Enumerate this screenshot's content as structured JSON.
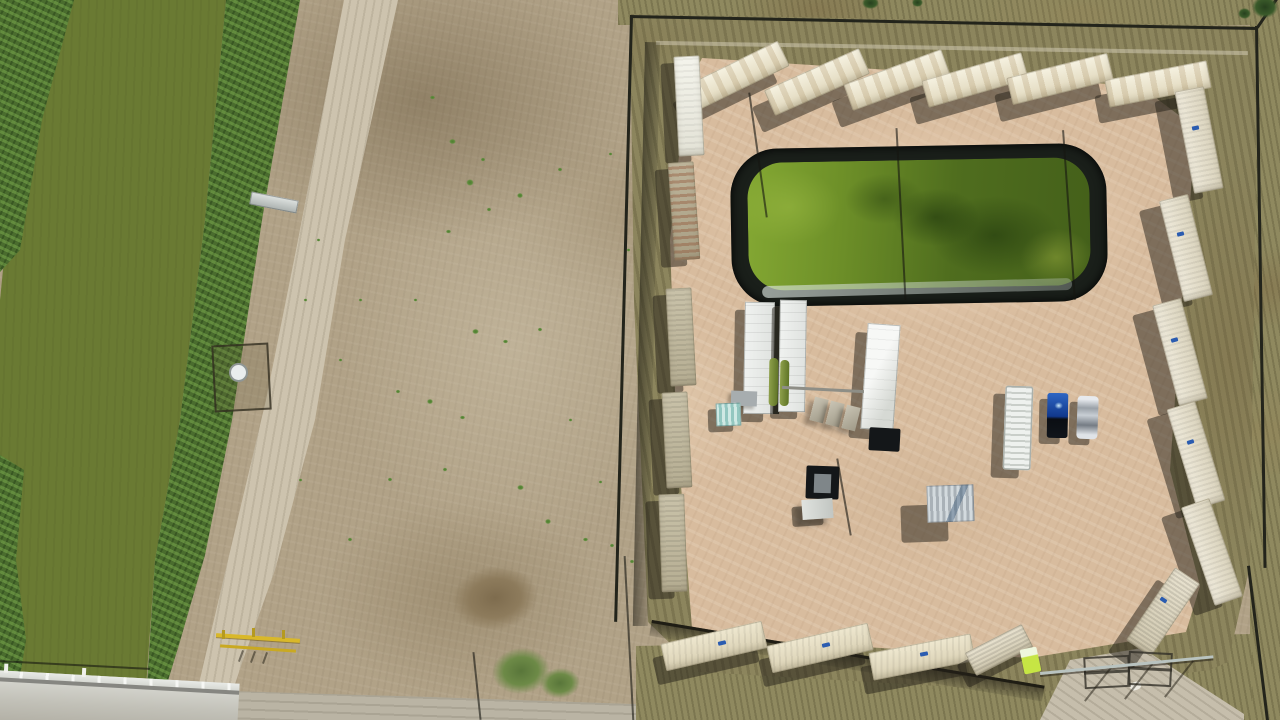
{
  "meta": {
    "scene_type": "aerial-drone-photo",
    "alt_text": "Top-down aerial view of a fenced well-pad compound ringed by shipping containers, with a black-lined green retention pond, white equipment trailers, two parked vehicles, a dirt road, and an irrigation canal with green water crossed by a concrete bridge"
  },
  "palette": {
    "field_tan": "#b1a287",
    "pad_pink": "#d8bc9e",
    "scrub_olive": "#8f895f",
    "canal_water_green": "#6a7a33",
    "vegetation_green": "#4a6c2e",
    "pond_water_green": "#5f7f24",
    "pond_liner_black": "#1a1f1a",
    "container_cream": "#e9e2ca",
    "road_tan": "#cdc3ae",
    "bridge_concrete": "#c6c5bc",
    "truck_blue": "#11388c",
    "gate_yellow": "#d9b829",
    "shadow": "rgba(36,31,24,0.5)"
  },
  "scene": {
    "objects": [
      {
        "n": "container-top-1",
        "cls": "cont top",
        "x": 685,
        "y": 62,
        "w": 104,
        "h": 28,
        "r": -26,
        "sx": -12,
        "sy": 17
      },
      {
        "n": "container-top-2",
        "cls": "cont top",
        "x": 765,
        "y": 68,
        "w": 104,
        "h": 28,
        "r": -24,
        "sx": -12,
        "sy": 17
      },
      {
        "n": "container-top-3",
        "cls": "cont top",
        "x": 845,
        "y": 66,
        "w": 104,
        "h": 28,
        "r": -20,
        "sx": -12,
        "sy": 17
      },
      {
        "n": "container-top-4",
        "cls": "cont top",
        "x": 923,
        "y": 66,
        "w": 104,
        "h": 28,
        "r": -16,
        "sx": -12,
        "sy": 17
      },
      {
        "n": "container-top-5",
        "cls": "cont top",
        "x": 1008,
        "y": 65,
        "w": 104,
        "h": 28,
        "r": -14,
        "sx": -12,
        "sy": 17
      },
      {
        "n": "container-top-6",
        "cls": "cont top",
        "x": 1106,
        "y": 70,
        "w": 104,
        "h": 28,
        "r": -11,
        "sx": -10,
        "sy": 16
      },
      {
        "n": "container-right-1",
        "cls": "cont side",
        "x": 1184,
        "y": 88,
        "w": 30,
        "h": 104,
        "r": -11,
        "sx": -20,
        "sy": 10
      },
      {
        "n": "container-right-2",
        "cls": "cont side",
        "x": 1171,
        "y": 196,
        "w": 30,
        "h": 104,
        "r": -14,
        "sx": -20,
        "sy": 10
      },
      {
        "n": "container-right-3",
        "cls": "cont side",
        "x": 1165,
        "y": 300,
        "w": 30,
        "h": 104,
        "r": -15,
        "sx": -20,
        "sy": 10
      },
      {
        "n": "container-right-4",
        "cls": "cont side",
        "x": 1181,
        "y": 403,
        "w": 30,
        "h": 104,
        "r": -17,
        "sx": -20,
        "sy": 10
      },
      {
        "n": "container-right-5",
        "cls": "cont side",
        "x": 1197,
        "y": 500,
        "w": 30,
        "h": 104,
        "r": -19,
        "sx": -20,
        "sy": 10
      },
      {
        "n": "container-corner",
        "cls": "cont corner",
        "x": 1148,
        "y": 568,
        "w": 30,
        "h": 88,
        "r": 34,
        "sx": -18,
        "sy": 12
      },
      {
        "n": "container-left-1",
        "cls": "cont white",
        "x": 676,
        "y": 56,
        "w": 26,
        "h": 100,
        "r": -3,
        "sx": -13,
        "sy": 7
      },
      {
        "n": "container-left-2",
        "cls": "cont rusty",
        "x": 671,
        "y": 162,
        "w": 26,
        "h": 98,
        "r": -4,
        "sx": -13,
        "sy": 7
      },
      {
        "n": "container-left-3",
        "cls": "cont leftc",
        "x": 668,
        "y": 288,
        "w": 26,
        "h": 98,
        "r": -3,
        "sx": -13,
        "sy": 7
      },
      {
        "n": "container-left-4",
        "cls": "cont leftc",
        "x": 664,
        "y": 392,
        "w": 26,
        "h": 96,
        "r": -3,
        "sx": -13,
        "sy": 7
      },
      {
        "n": "container-left-5",
        "cls": "cont leftc",
        "x": 660,
        "y": 494,
        "w": 26,
        "h": 98,
        "r": -2,
        "sx": -13,
        "sy": 7
      },
      {
        "n": "container-bottom-1",
        "cls": "cont bot",
        "x": 662,
        "y": 632,
        "w": 104,
        "h": 28,
        "r": -13,
        "sx": -8,
        "sy": 14
      },
      {
        "n": "container-bottom-2",
        "cls": "cont bot",
        "x": 768,
        "y": 634,
        "w": 104,
        "h": 28,
        "r": -13,
        "sx": -8,
        "sy": 14
      },
      {
        "n": "container-bottom-3",
        "cls": "cont bot",
        "x": 870,
        "y": 643,
        "w": 104,
        "h": 28,
        "r": -11,
        "sx": -8,
        "sy": 14
      },
      {
        "n": "container-bottom-4",
        "cls": "cont corner",
        "x": 967,
        "y": 637,
        "w": 64,
        "h": 26,
        "r": -27,
        "sx": -8,
        "sy": 12
      },
      {
        "n": "container-label",
        "cls": "chip",
        "x": 1192,
        "y": 126,
        "w": 7,
        "h": 4,
        "r": -11
      },
      {
        "n": "container-label",
        "cls": "chip",
        "x": 1177,
        "y": 232,
        "w": 7,
        "h": 4,
        "r": -14
      },
      {
        "n": "container-label",
        "cls": "chip",
        "x": 1171,
        "y": 338,
        "w": 7,
        "h": 4,
        "r": -15
      },
      {
        "n": "container-label",
        "cls": "chip",
        "x": 1187,
        "y": 440,
        "w": 7,
        "h": 4,
        "r": -17
      },
      {
        "n": "container-label",
        "cls": "chip",
        "x": 1160,
        "y": 598,
        "w": 7,
        "h": 4,
        "r": 34
      },
      {
        "n": "container-label",
        "cls": "chip",
        "x": 718,
        "y": 641,
        "w": 8,
        "h": 4,
        "r": -13
      },
      {
        "n": "container-label",
        "cls": "chip",
        "x": 822,
        "y": 643,
        "w": 8,
        "h": 4,
        "r": -13
      },
      {
        "n": "container-label",
        "cls": "chip",
        "x": 920,
        "y": 652,
        "w": 8,
        "h": 4,
        "r": -11
      },
      {
        "n": "equipment-gap",
        "cls": "gapd",
        "x": 771,
        "y": 306,
        "w": 9,
        "h": 108,
        "r": 1
      },
      {
        "n": "frac-tank-trailer-a",
        "cls": "trailer",
        "x": 744,
        "y": 302,
        "w": 30,
        "h": 112,
        "r": 1,
        "sx": -10,
        "sy": 8
      },
      {
        "n": "frac-tank-trailer-b",
        "cls": "trailer",
        "x": 779,
        "y": 300,
        "w": 27,
        "h": 112,
        "r": 1,
        "sx": -8,
        "sy": 7
      },
      {
        "n": "green-tank-1",
        "cls": "gtank",
        "x": 769,
        "y": 358,
        "w": 9,
        "h": 48,
        "r": 1
      },
      {
        "n": "green-tank-2",
        "cls": "gtank",
        "x": 780,
        "y": 360,
        "w": 9,
        "h": 46,
        "r": 1
      },
      {
        "n": "equipment-trailer-c",
        "cls": "trailer bright",
        "x": 864,
        "y": 324,
        "w": 33,
        "h": 106,
        "r": 4,
        "sx": -12,
        "sy": 9
      },
      {
        "n": "black-platform",
        "cls": "cellar",
        "x": 869,
        "y": 428,
        "w": 31,
        "h": 23,
        "r": 3
      },
      {
        "n": "pipe-run",
        "cls": "pipe",
        "x": 782,
        "y": 388,
        "w": 82,
        "h": 3,
        "r": 3
      },
      {
        "n": "skid-pad-1",
        "cls": "pad3",
        "x": 812,
        "y": 398,
        "w": 14,
        "h": 24,
        "r": 14
      },
      {
        "n": "skid-pad-2",
        "cls": "pad3",
        "x": 828,
        "y": 402,
        "w": 14,
        "h": 24,
        "r": 14
      },
      {
        "n": "skid-pad-3",
        "cls": "pad3",
        "x": 844,
        "y": 406,
        "w": 14,
        "h": 24,
        "r": 14
      },
      {
        "n": "gray-utility-box",
        "cls": "unit",
        "x": 731,
        "y": 391,
        "w": 26,
        "h": 15,
        "r": 2
      },
      {
        "n": "wellhead-cellar",
        "cls": "cellar",
        "x": 806,
        "y": 466,
        "w": 33,
        "h": 33,
        "r": 2
      },
      {
        "n": "wellhead",
        "cls": "cellinner",
        "x": 814,
        "y": 474,
        "w": 17,
        "h": 19,
        "r": 2
      },
      {
        "n": "white-service-unit",
        "cls": "unit2",
        "x": 802,
        "y": 499,
        "w": 31,
        "h": 20,
        "r": -4,
        "sx": -10,
        "sy": 7
      },
      {
        "n": "corrugated-shed",
        "cls": "shed",
        "x": 927,
        "y": 485,
        "w": 47,
        "h": 37,
        "r": -2,
        "sx": -26,
        "sy": 20
      },
      {
        "n": "teal-shed",
        "cls": "teal",
        "x": 716,
        "y": 403,
        "w": 25,
        "h": 23,
        "r": -2,
        "sx": -8,
        "sy": 6
      },
      {
        "n": "ribbed-tank-trailer",
        "cls": "ribbed",
        "x": 1004,
        "y": 386,
        "w": 28,
        "h": 84,
        "r": 2,
        "sx": -12,
        "sy": 8
      },
      {
        "n": "blue-pickup-truck",
        "cls": "truck",
        "x": 1047,
        "y": 393,
        "w": 21,
        "h": 45,
        "r": 1,
        "sx": -8,
        "sy": 6
      },
      {
        "n": "silver-car",
        "cls": "car",
        "x": 1077,
        "y": 396,
        "w": 21,
        "h": 43,
        "r": 2,
        "sx": -8,
        "sy": 6
      },
      {
        "n": "portable-toilet",
        "cls": "toilet",
        "x": 1022,
        "y": 648,
        "w": 17,
        "h": 25,
        "r": -12
      },
      {
        "n": "canal-walkway",
        "cls": "walk",
        "x": 250,
        "y": 196,
        "w": 48,
        "h": 13,
        "r": 11
      },
      {
        "n": "pump-enclosure",
        "cls": "enc",
        "x": 213,
        "y": 344,
        "w": 53,
        "h": 63,
        "r": -3
      },
      {
        "n": "round-tank",
        "cls": "circ",
        "x": 229,
        "y": 363,
        "w": 15,
        "h": 15,
        "r": 0
      },
      {
        "n": "yellow-gate-bar",
        "cls": "ybar",
        "x": 216,
        "y": 636,
        "w": 84,
        "h": 4,
        "r": 4
      },
      {
        "n": "yellow-gate-bar-2",
        "cls": "ybar2",
        "x": 220,
        "y": 647,
        "w": 76,
        "h": 3,
        "r": 4
      },
      {
        "n": "yellow-gate-post",
        "cls": "ypost",
        "x": 222,
        "y": 630,
        "w": 3,
        "h": 9,
        "r": 0
      },
      {
        "n": "yellow-gate-post",
        "cls": "ypost",
        "x": 252,
        "y": 628,
        "w": 3,
        "h": 9,
        "r": 0
      },
      {
        "n": "yellow-gate-post",
        "cls": "ypost",
        "x": 282,
        "y": 630,
        "w": 3,
        "h": 9,
        "r": 0
      },
      {
        "n": "gate-post-shadow",
        "cls": "gsh",
        "x": 240,
        "y": 650,
        "w": 2,
        "h": 12,
        "r": 20
      },
      {
        "n": "gate-post-shadow",
        "cls": "gsh",
        "x": 252,
        "y": 651,
        "w": 2,
        "h": 12,
        "r": 20
      },
      {
        "n": "gate-post-shadow",
        "cls": "gsh",
        "x": 264,
        "y": 652,
        "w": 2,
        "h": 12,
        "r": 20
      },
      {
        "n": "white-debris",
        "cls": "wdot",
        "x": 1130,
        "y": 682,
        "w": 11,
        "h": 8,
        "r": -18
      },
      {
        "n": "entry-gate-frame-1",
        "cls": "frame",
        "x": 1084,
        "y": 656,
        "w": 42,
        "h": 28,
        "r": -3
      },
      {
        "n": "entry-gate-frame-2",
        "cls": "frame",
        "x": 1128,
        "y": 652,
        "w": 40,
        "h": 30,
        "r": 3
      },
      {
        "n": "gate-post-shadow",
        "cls": "gsh",
        "x": 1098,
        "y": 660,
        "w": 2,
        "h": 46,
        "r": 38
      },
      {
        "n": "gate-post-shadow",
        "cls": "gsh",
        "x": 1138,
        "y": 658,
        "w": 2,
        "h": 46,
        "r": 38
      },
      {
        "n": "gate-post-shadow",
        "cls": "gsh",
        "x": 1178,
        "y": 656,
        "w": 2,
        "h": 46,
        "r": 38
      },
      {
        "n": "guy-wire",
        "cls": "cable",
        "x": 900,
        "y": 128,
        "w": 2,
        "h": 172,
        "r": -3
      },
      {
        "n": "guy-wire",
        "cls": "cable",
        "x": 1068,
        "y": 130,
        "w": 2,
        "h": 170,
        "r": -4
      },
      {
        "n": "pole-shadow",
        "cls": "cable",
        "x": 757,
        "y": 92,
        "w": 2,
        "h": 126,
        "r": -8
      },
      {
        "n": "boom-shadow",
        "cls": "cable",
        "x": 843,
        "y": 458,
        "w": 2,
        "h": 78,
        "r": -10
      },
      {
        "n": "fence-wire",
        "cls": "cable",
        "x": 476,
        "y": 652,
        "w": 2,
        "h": 68,
        "r": -6
      },
      {
        "n": "fence-wire",
        "cls": "cable",
        "x": 628,
        "y": 556,
        "w": 2,
        "h": 166,
        "r": -3
      },
      {
        "n": "power-line",
        "cls": "cable",
        "x": 0,
        "y": 664,
        "w": 150,
        "h": 2,
        "r": 3
      },
      {
        "n": "rubble-patch",
        "cls": "rubble",
        "x": 452,
        "y": 566,
        "w": 86,
        "h": 64,
        "r": -8
      },
      {
        "n": "grass-patch",
        "cls": "gpatch",
        "x": 492,
        "y": 648,
        "w": 58,
        "h": 46,
        "r": -6
      },
      {
        "n": "grass-patch",
        "cls": "gpatch",
        "x": 540,
        "y": 668,
        "w": 40,
        "h": 30,
        "r": -4
      },
      {
        "n": "tree-canopy",
        "cls": "tree",
        "x": 1252,
        "y": -4,
        "w": 26,
        "h": 22,
        "r": 0
      },
      {
        "n": "tree-canopy",
        "cls": "tree",
        "x": 1238,
        "y": 8,
        "w": 13,
        "h": 11,
        "r": 0
      },
      {
        "n": "tree-canopy",
        "cls": "tree",
        "x": 862,
        "y": -3,
        "w": 17,
        "h": 12,
        "r": 0
      },
      {
        "n": "tree-canopy",
        "cls": "tree",
        "x": 912,
        "y": -2,
        "w": 11,
        "h": 9,
        "r": 0
      }
    ],
    "bushes": [
      [
        432,
        98,
        7
      ],
      [
        452,
        142,
        9
      ],
      [
        470,
        183,
        10
      ],
      [
        483,
        160,
        6
      ],
      [
        448,
        232,
        7
      ],
      [
        489,
        210,
        6
      ],
      [
        520,
        196,
        8
      ],
      [
        560,
        170,
        6
      ],
      [
        610,
        154,
        5
      ],
      [
        475,
        332,
        9
      ],
      [
        505,
        342,
        7
      ],
      [
        540,
        330,
        6
      ],
      [
        430,
        402,
        8
      ],
      [
        462,
        418,
        7
      ],
      [
        398,
        392,
        6
      ],
      [
        520,
        488,
        9
      ],
      [
        548,
        522,
        8
      ],
      [
        585,
        540,
        7
      ],
      [
        612,
        546,
        6
      ],
      [
        628,
        250,
        5
      ],
      [
        360,
        300,
        5
      ],
      [
        340,
        360,
        5
      ],
      [
        390,
        480,
        6
      ],
      [
        350,
        540,
        6
      ],
      [
        305,
        300,
        5
      ],
      [
        318,
        240,
        5
      ],
      [
        300,
        480,
        5
      ],
      [
        632,
        562,
        6
      ],
      [
        600,
        482,
        5
      ],
      [
        570,
        420,
        5
      ],
      [
        415,
        300,
        5
      ],
      [
        445,
        470,
        6
      ]
    ]
  }
}
